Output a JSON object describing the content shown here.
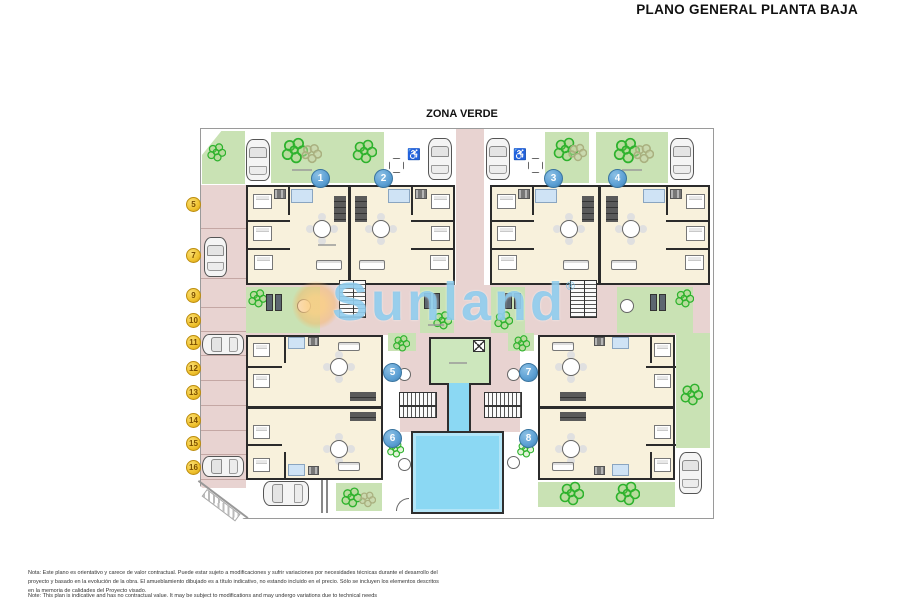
{
  "title": "PLANO GENERAL PLANTA BAJA",
  "zone_label": "ZONA VERDE",
  "watermark": {
    "text": "Sunland",
    "reg": "®"
  },
  "units": {
    "top": [
      "1",
      "2",
      "3",
      "4"
    ],
    "bottom": [
      "5",
      "6",
      "7",
      "8"
    ]
  },
  "parking": [
    "5",
    "7",
    "9",
    "10",
    "11",
    "12",
    "13",
    "14",
    "15",
    "16"
  ],
  "icons": {
    "accessible": "♿"
  },
  "notes": {
    "es": "Nota: Este plano es orientativo y carece de valor contractual. Puede estar sujeto a modificaciones y sufrir variaciones por necesidades técnicas durante el desarrollo del proyecto y basado en la evolución de la obra. El amueblamiento dibujado es a título indicativo, no estando incluido en el precio. Sólo se incluyen los elementos descritos en la memoria de calidades del Proyecto visado.",
    "en": "Note: This plan is indicative and has no contractual value. It may be subject to modifications and may undergo variations due to technical needs"
  },
  "colors": {
    "walkway_pink": "#e8d3d1",
    "green_zone": "#c9e2b4",
    "apartment_floor": "#f8f1dc",
    "bathroom_blue": "#cfe3f5",
    "pool_blue": "#8bd8f3",
    "unit_marker_blue": "#5b9fd4",
    "parking_marker_yellow": "#f0c22e",
    "wall": "#2b2b2b",
    "watermark_blue": "#7dc4ea",
    "watermark_sun": "#f6b869"
  }
}
